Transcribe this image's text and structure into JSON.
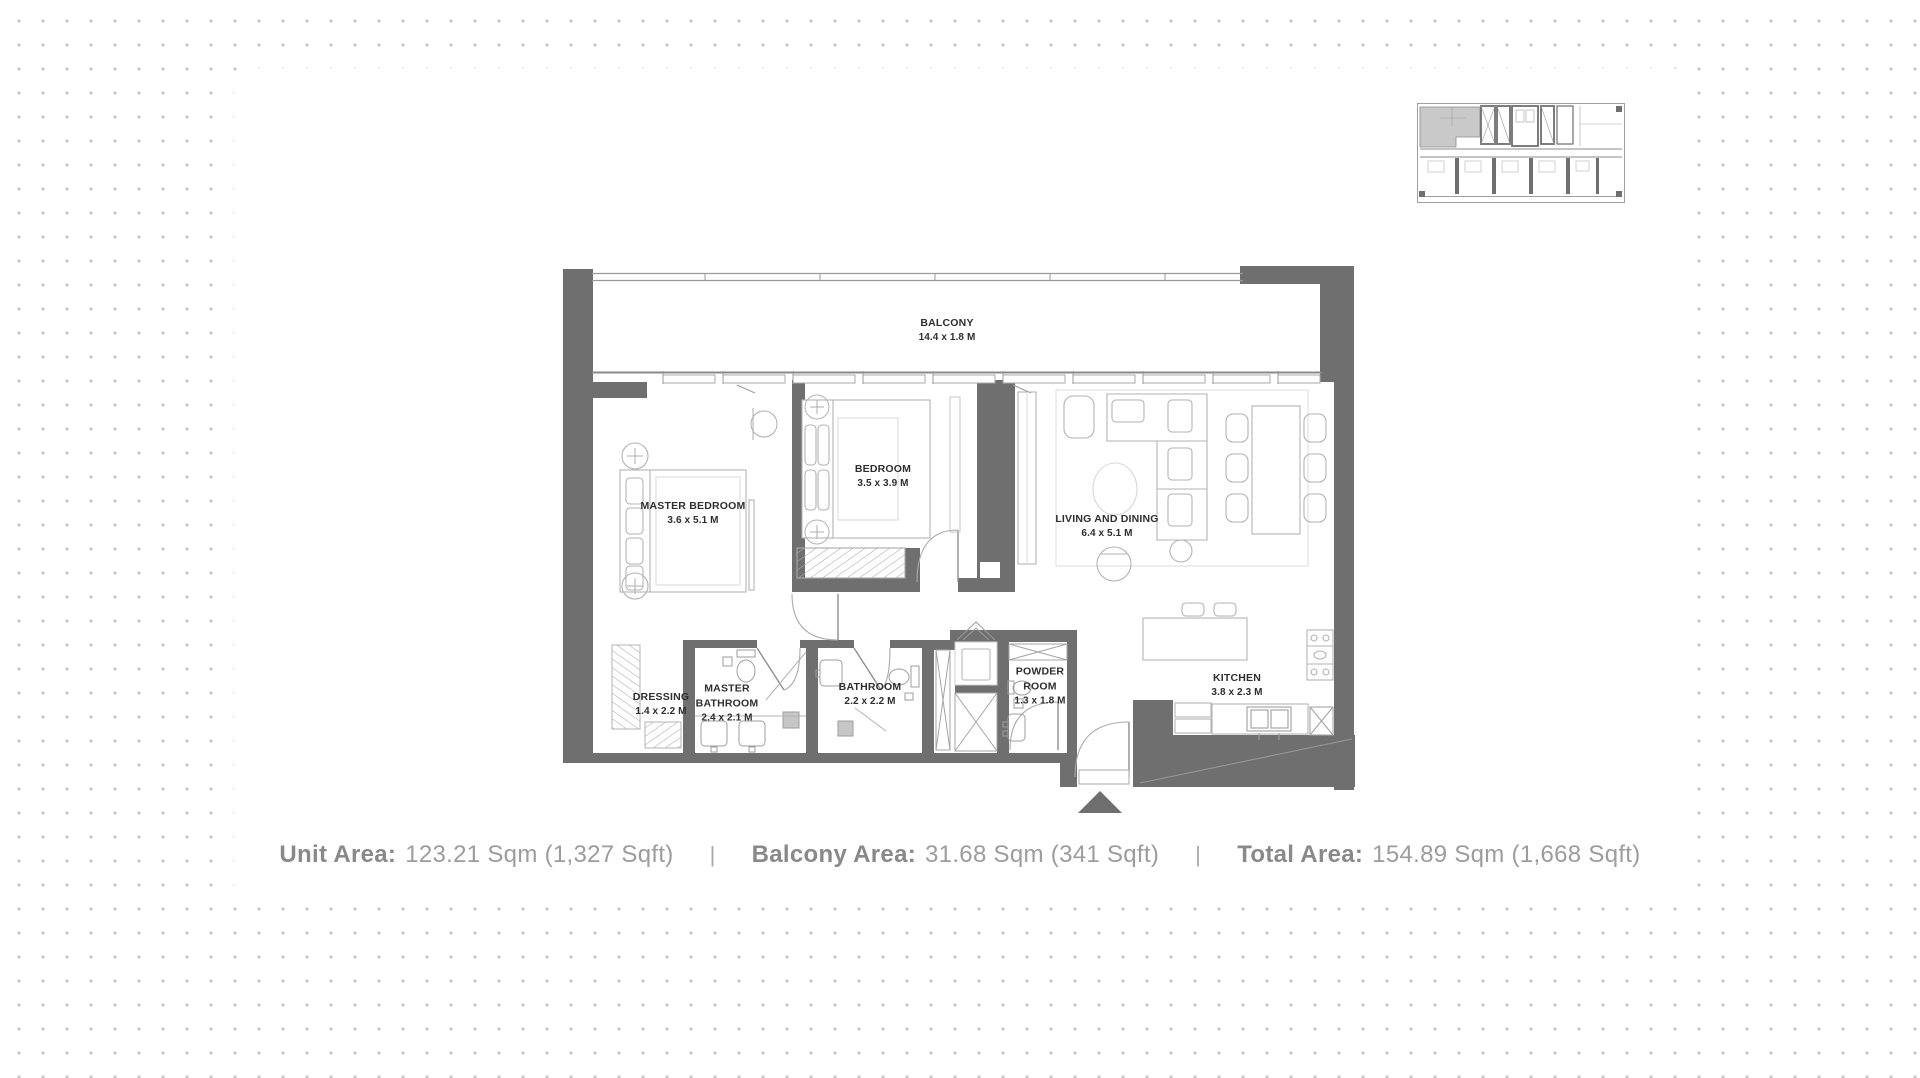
{
  "plan": {
    "wall_color": "#6f6f6f",
    "rooms": [
      {
        "id": "balcony",
        "name": "BALCONY",
        "dims": "14.4 x 1.8 M"
      },
      {
        "id": "master-bedroom",
        "name": "MASTER BEDROOM",
        "dims": "3.6 x 5.1 M"
      },
      {
        "id": "bedroom",
        "name": "BEDROOM",
        "dims": "3.5 x 3.9 M"
      },
      {
        "id": "living-dining",
        "name": "LIVING AND DINING",
        "dims": "6.4 x 5.1 M"
      },
      {
        "id": "dressing",
        "name": "DRESSING",
        "dims": "1.4 x 2.2 M"
      },
      {
        "id": "master-bathroom",
        "name": "MASTER BATHROOM",
        "dims": "2.4 x 2.1 M"
      },
      {
        "id": "bathroom",
        "name": "BATHROOM",
        "dims": "2.2 x 2.2 M"
      },
      {
        "id": "powder-room",
        "name": "POWDER ROOM",
        "dims": "1.3 x 1.8 M"
      },
      {
        "id": "kitchen",
        "name": "KITCHEN",
        "dims": "3.8 x 2.3 M"
      }
    ]
  },
  "key_plan": {
    "highlight_color": "#c9c9c9"
  },
  "stats": {
    "separator": "|",
    "items": [
      {
        "label": "Unit Area:",
        "value": "123.21 Sqm (1,327 Sqft)"
      },
      {
        "label": "Balcony Area:",
        "value": "31.68 Sqm (341 Sqft)"
      },
      {
        "label": "Total Area:",
        "value": "154.89 Sqm (1,668 Sqft)"
      }
    ]
  }
}
